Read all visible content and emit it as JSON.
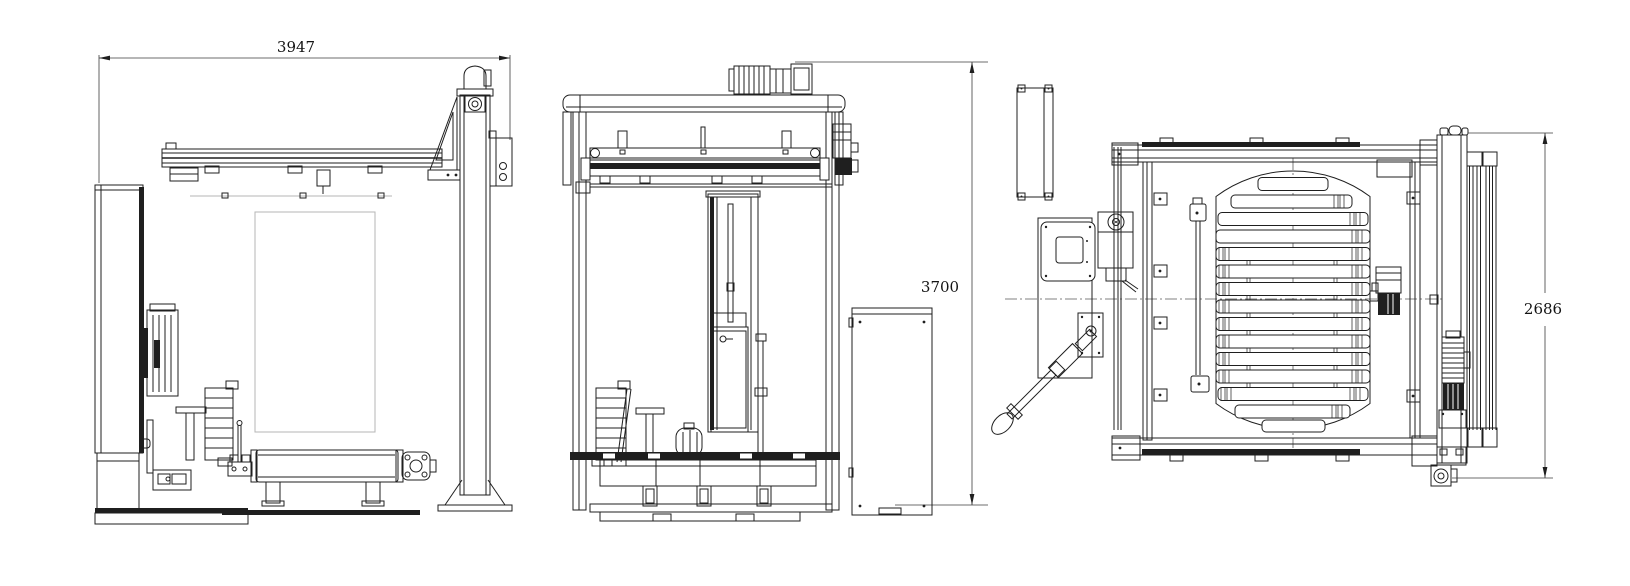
{
  "page": {
    "background": "#ffffff"
  },
  "drawing": {
    "line_color": "#1f1f1f",
    "hidden_line_color": "#b5b5b5",
    "centerline_color": "#5a5a5a",
    "dimensions": [
      {
        "id": "overall-width",
        "text": "3947"
      },
      {
        "id": "overall-height",
        "text": "3700"
      },
      {
        "id": "overall-depth",
        "text": "2686"
      }
    ]
  }
}
